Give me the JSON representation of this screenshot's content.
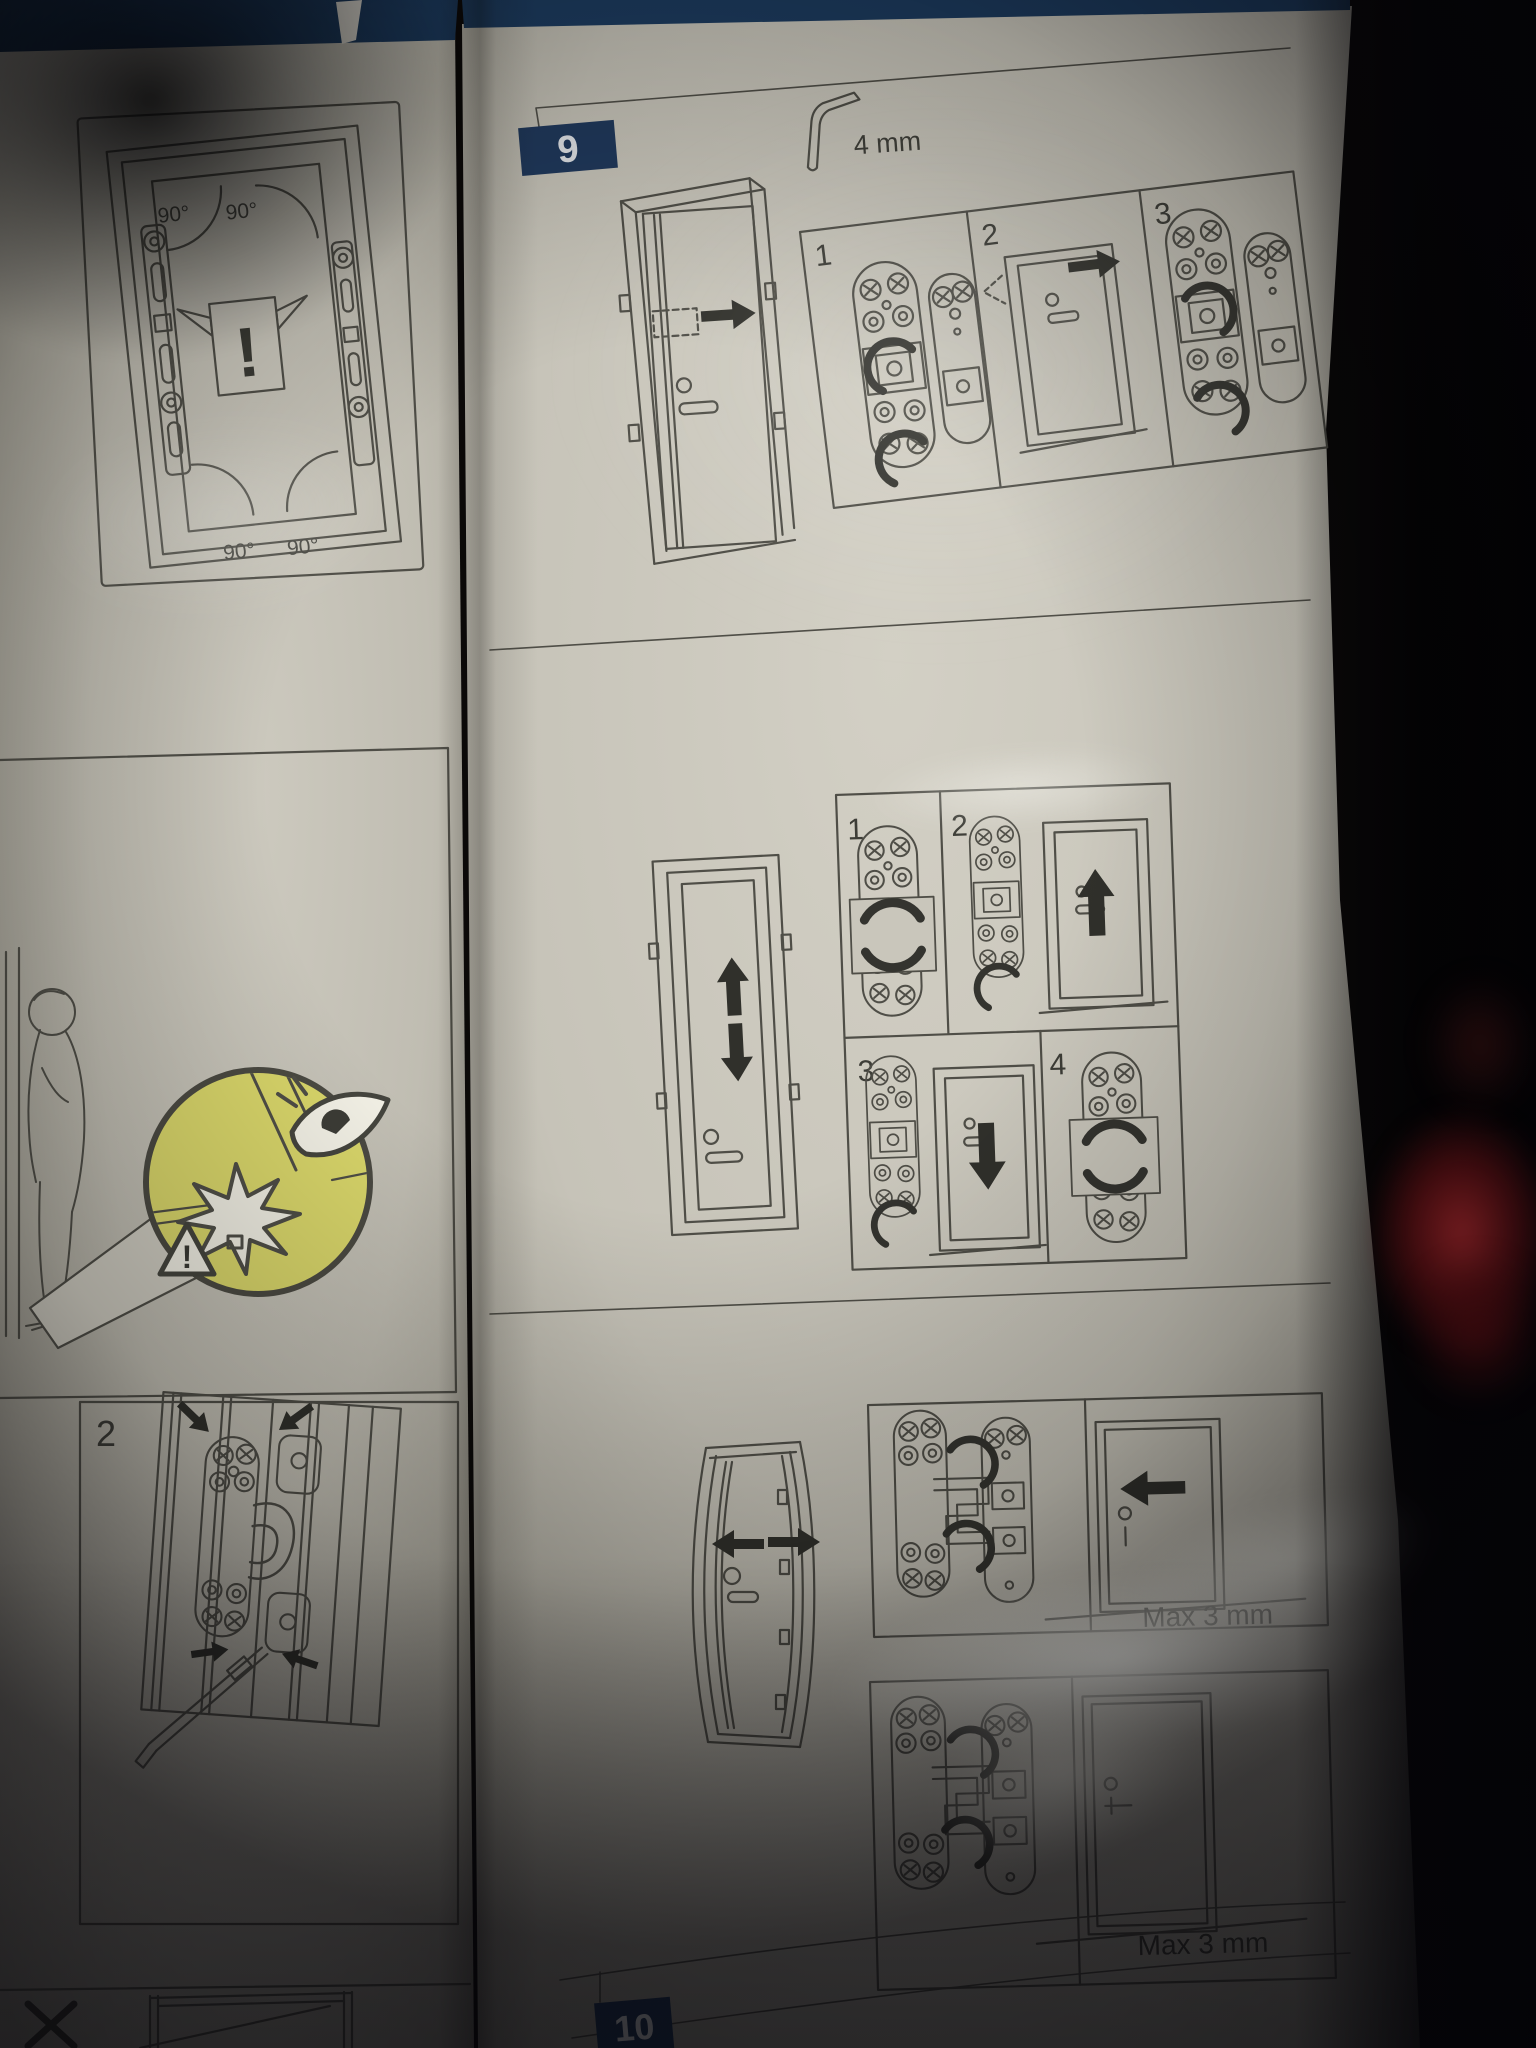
{
  "left_page": {
    "top_panel": {
      "angle_top_left": "90°",
      "angle_top_right": "90°",
      "angle_bottom_left": "90°",
      "angle_bottom_right": "90°",
      "warning_mark": "!"
    },
    "caution": {
      "triangle_mark": "!"
    },
    "step2_panel": {
      "number": "2"
    }
  },
  "right_page": {
    "step9": {
      "badge": "9",
      "tool_size": "4 mm",
      "block_a": {
        "panel_1": "1",
        "panel_2": "2",
        "panel_3": "3"
      },
      "block_b": {
        "panel_1": "1",
        "panel_2": "2",
        "panel_3": "3",
        "panel_4": "4"
      },
      "block_c": {
        "max_label": "Max 3 mm"
      },
      "block_d": {
        "max_label": "Max 3 mm"
      }
    },
    "step10": {
      "badge": "10"
    }
  },
  "colors": {
    "badge_navy": "#20395c",
    "highlight_yellow": "#d9d66a",
    "ink": "#4a4a43",
    "arrow_black": "#30302b",
    "paper": "#c9c6bb",
    "red_object": "#8e1b20"
  }
}
